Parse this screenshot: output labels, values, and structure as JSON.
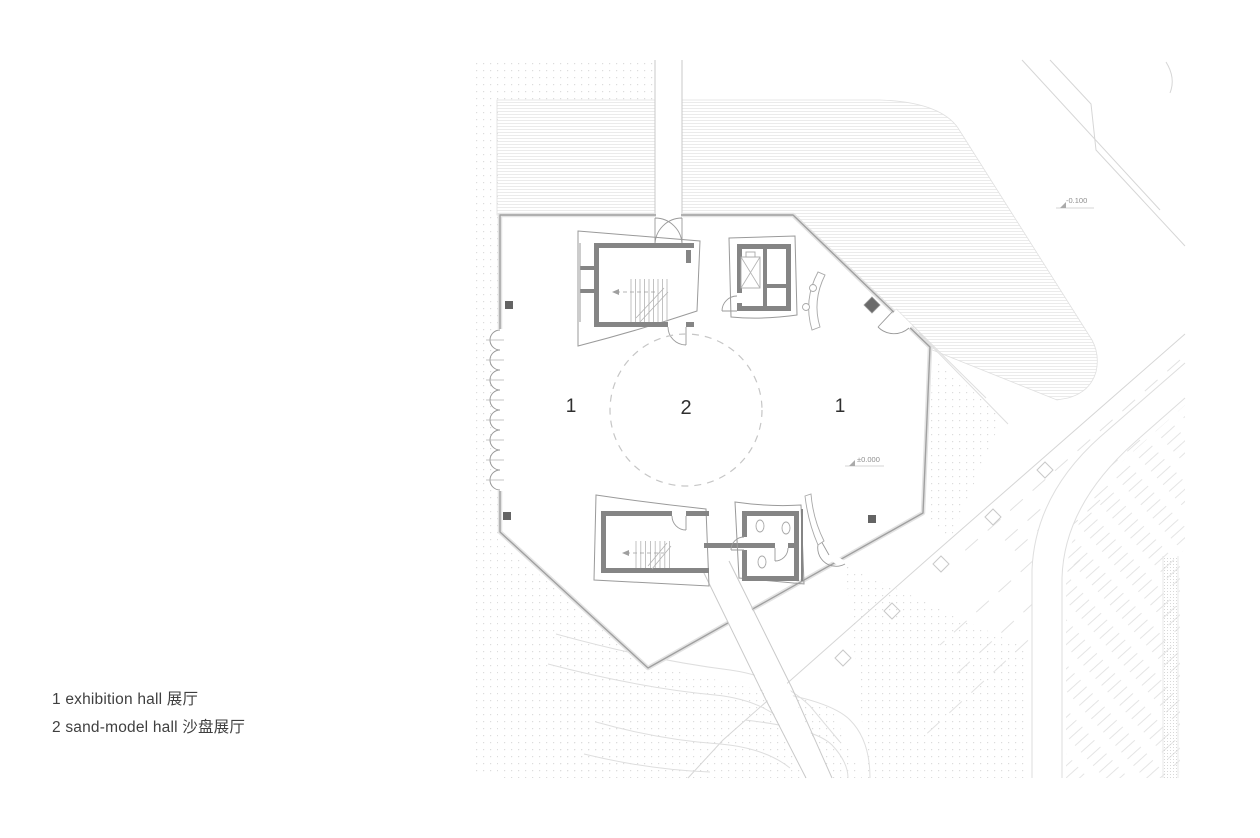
{
  "legend": {
    "items": [
      {
        "id": "exhibition-hall",
        "text": "1 exhibition hall 展厅"
      },
      {
        "id": "sand-model-hall",
        "text": "2 sand-model hall 沙盘展厅"
      }
    ]
  },
  "plan": {
    "room_labels": [
      {
        "id": "exhibition-hall-west",
        "text": "1"
      },
      {
        "id": "sand-model-hall-center",
        "text": "2"
      },
      {
        "id": "exhibition-hall-east",
        "text": "1"
      }
    ],
    "level_annotations": [
      {
        "id": "floor-level",
        "text": "±0.000"
      },
      {
        "id": "site-level",
        "text": "-0.100"
      }
    ],
    "colors": {
      "background": "#ffffff",
      "wall_fill": "#858585",
      "building_outline": "#a0a0a0",
      "site_lines": "#dedede",
      "dashed_circle": "#c6c6c6",
      "column_fill": "#646464",
      "label_text": "#2f2f2f",
      "annotation_text": "#8f8f8f"
    }
  }
}
